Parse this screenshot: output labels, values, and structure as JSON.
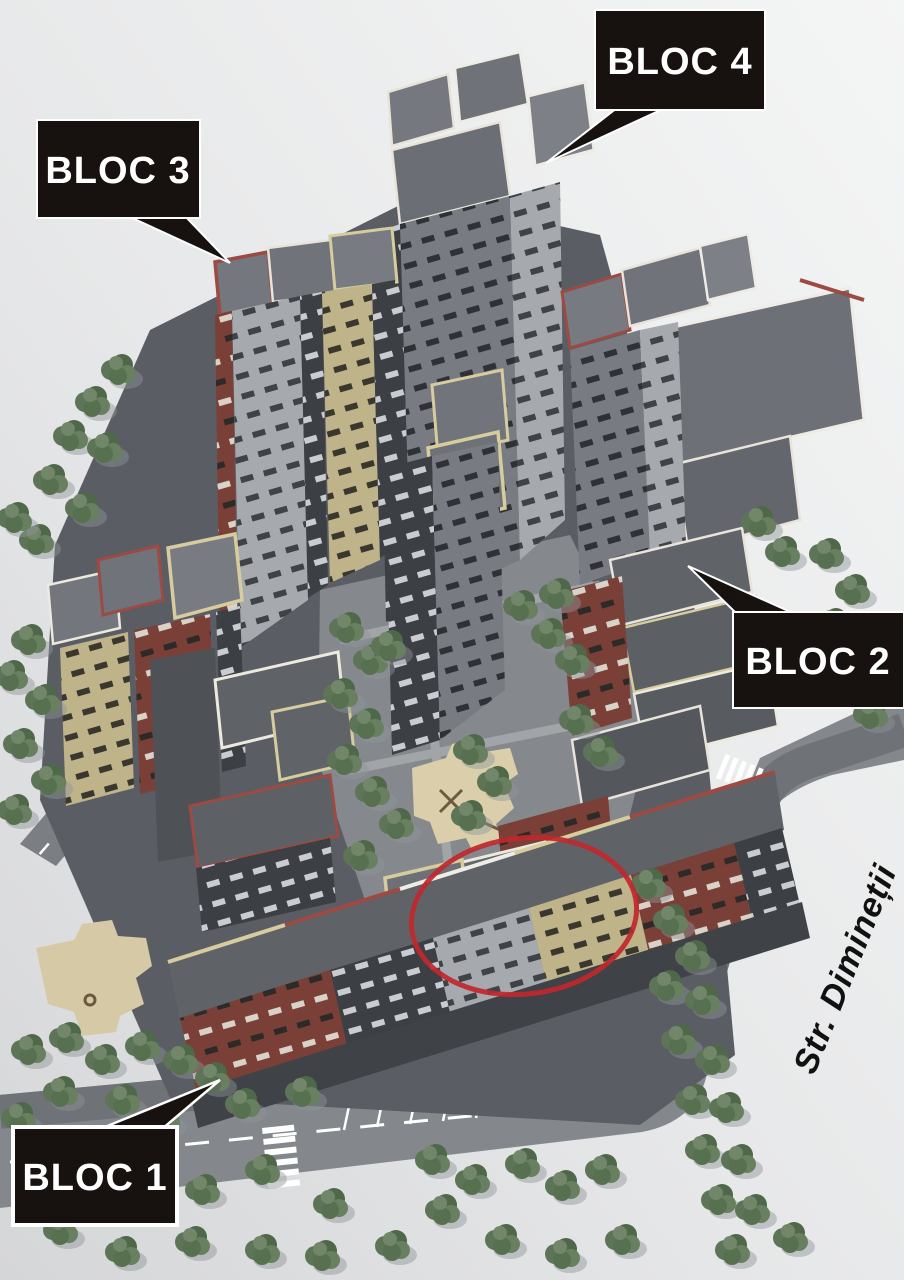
{
  "scene": {
    "description": "Aerial 3D rendering of a residential complex with four labeled apartment blocks, internal courtyards, tree-lined roads and a red ellipse highlighting one building",
    "labels": [
      {
        "id": "bloc-4",
        "text": "BLOC 4"
      },
      {
        "id": "bloc-3",
        "text": "BLOC 3"
      },
      {
        "id": "bloc-2",
        "text": "BLOC 2"
      },
      {
        "id": "bloc-1",
        "text": "BLOC 1"
      }
    ],
    "street": {
      "name": "Str. Dimineții"
    },
    "annotation_colors": {
      "callout_bg": "#17120f",
      "callout_fg": "#ffffff",
      "highlight_ellipse": "#c1272d"
    },
    "palette": {
      "background": "#eceeef",
      "asphalt": "#55585e",
      "roof_gray": "#6d7177",
      "parapet_white": "#eeece4",
      "parapet_cream": "#d6cc9e",
      "parapet_red": "#9c4a42",
      "facade_dark": "#3c3f44",
      "facade_brick": "#7a4038",
      "facade_beige": "#bfb38a",
      "facade_light": "#a6aaae",
      "tree_green": "#57704f",
      "playground_sand": "#dbcfab"
    }
  }
}
